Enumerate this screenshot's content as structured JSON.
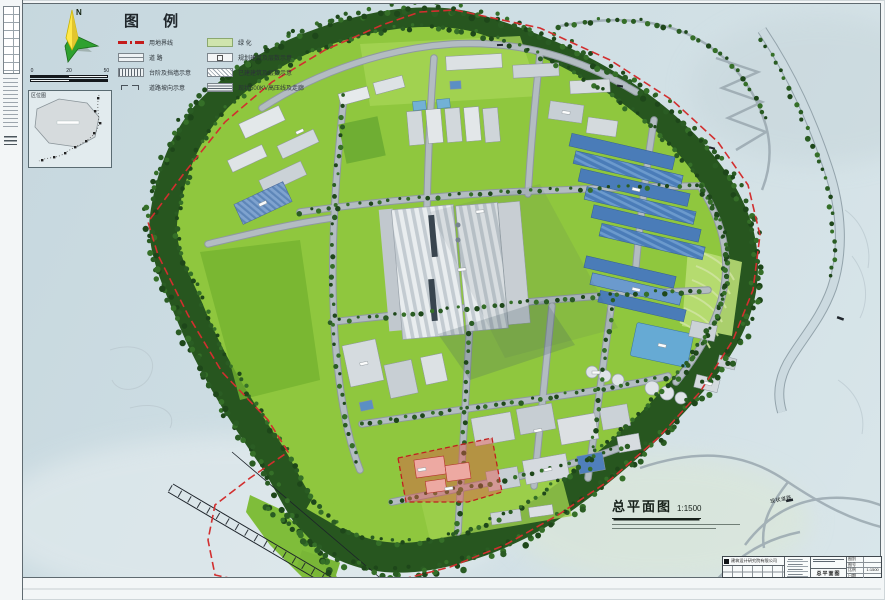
{
  "legend": {
    "title": "图  例",
    "left_items": [
      {
        "label": "用地界线"
      },
      {
        "label": "道  路"
      },
      {
        "label": "台阶及挡墙示意"
      },
      {
        "label": "道路坡向示意"
      }
    ],
    "right_items": [
      {
        "label": "绿  化"
      },
      {
        "label": "规划建筑及层数示意"
      },
      {
        "label": "已建建筑及层数示意"
      },
      {
        "label": "现状500KV高压线及走廊"
      }
    ]
  },
  "compass": {
    "north_label": "N"
  },
  "scalebar": {
    "ticks": [
      "0",
      "20",
      "50"
    ]
  },
  "inset": {
    "title": "区位图"
  },
  "plan_label": {
    "name": "总平面图",
    "scale": "1:1500"
  },
  "map_labels": {
    "road": "现状道路"
  },
  "titleblock": {
    "company": "建筑设计研究院有限公司",
    "drawing_name": "总平面图",
    "fields": [
      {
        "label": "图别",
        "value": ""
      },
      {
        "label": "图号",
        "value": ""
      },
      {
        "label": "比例",
        "value": "1:1500"
      },
      {
        "label": "日期",
        "value": ""
      }
    ]
  }
}
